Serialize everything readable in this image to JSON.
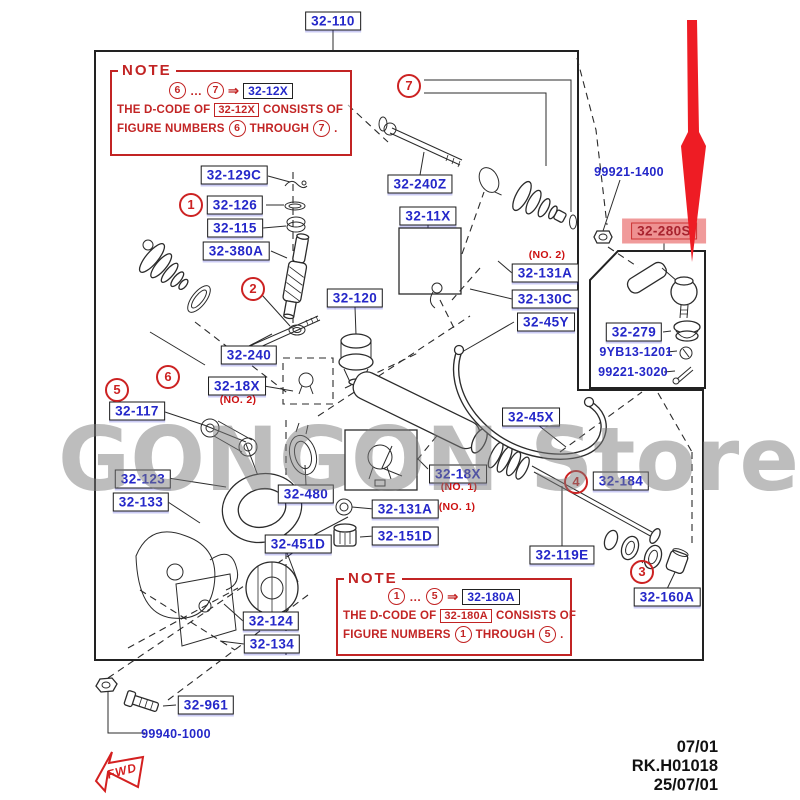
{
  "meta": {
    "store_watermark": "GONGON Store"
  },
  "colors": {
    "label_blue": "#2427c9",
    "note_red": "#c22424",
    "highlight_pink": "#f09a9a",
    "arrow_red": "#ee1c24",
    "line": "#2b2b2b",
    "watermark_gray": "#7d7d7d"
  },
  "header": {
    "assembly_label": "32-110"
  },
  "notes": {
    "top": {
      "heading": "NOTE",
      "from": "6",
      "dots": "…",
      "to": "7",
      "arrow": "⇒",
      "code": "32-12X",
      "line2_a": "THE D-CODE OF",
      "line2_b": "CONSISTS OF",
      "line3_a": "FIGURE NUMBERS",
      "line3_b": "THROUGH",
      "period": "."
    },
    "bottom": {
      "heading": "NOTE",
      "from": "1",
      "dots": "…",
      "to": "5",
      "arrow": "⇒",
      "code": "32-180A",
      "line2_a": "THE D-CODE OF",
      "line2_b": "CONSISTS OF",
      "line3_a": "FIGURE NUMBERS",
      "line3_b": "THROUGH",
      "period": "."
    }
  },
  "part_labels": [
    {
      "t": "32-110",
      "x": 333,
      "y": 21
    },
    {
      "t": "32-129C",
      "x": 234,
      "y": 175
    },
    {
      "t": "32-126",
      "x": 235,
      "y": 205
    },
    {
      "t": "32-115",
      "x": 235,
      "y": 228
    },
    {
      "t": "32-380A",
      "x": 236,
      "y": 251
    },
    {
      "t": "32-240Z",
      "x": 420,
      "y": 184
    },
    {
      "t": "32-11X",
      "x": 428,
      "y": 216
    },
    {
      "t": "32-120",
      "x": 355,
      "y": 298
    },
    {
      "t": "32-131A",
      "x": 545,
      "y": 273
    },
    {
      "t": "32-130C",
      "x": 545,
      "y": 299
    },
    {
      "t": "32-45Y",
      "x": 546,
      "y": 322
    },
    {
      "t": "32-240",
      "x": 249,
      "y": 355
    },
    {
      "t": "32-18X",
      "x": 237,
      "y": 386
    },
    {
      "t": "32-117",
      "x": 137,
      "y": 411
    },
    {
      "t": "32-45X",
      "x": 531,
      "y": 417
    },
    {
      "t": "32-123",
      "x": 143,
      "y": 479
    },
    {
      "t": "32-133",
      "x": 141,
      "y": 502
    },
    {
      "t": "32-480",
      "x": 306,
      "y": 494
    },
    {
      "t": "32-18X",
      "x": 458,
      "y": 474
    },
    {
      "t": "32-131A",
      "x": 405,
      "y": 509
    },
    {
      "t": "32-151D",
      "x": 405,
      "y": 536
    },
    {
      "t": "32-451D",
      "x": 298,
      "y": 544
    },
    {
      "t": "32-119E",
      "x": 562,
      "y": 555
    },
    {
      "t": "32-184",
      "x": 621,
      "y": 481
    },
    {
      "t": "32-160A",
      "x": 667,
      "y": 597
    },
    {
      "t": "32-124",
      "x": 271,
      "y": 621
    },
    {
      "t": "32-134",
      "x": 272,
      "y": 644
    },
    {
      "t": "32-961",
      "x": 206,
      "y": 705
    },
    {
      "t": "32-279",
      "x": 634,
      "y": 332
    }
  ],
  "plain_labels": [
    {
      "t": "99921-1400",
      "x": 629,
      "y": 172
    },
    {
      "t": "9YB13-1201",
      "x": 636,
      "y": 352
    },
    {
      "t": "99221-3020",
      "x": 633,
      "y": 372
    },
    {
      "t": "99940-1000",
      "x": 176,
      "y": 734
    }
  ],
  "highlight_label": {
    "t": "32-280S",
    "x": 664,
    "y": 231
  },
  "red_notes": [
    {
      "t": "(NO. 2)",
      "x": 547,
      "y": 255
    },
    {
      "t": "(NO. 2)",
      "x": 238,
      "y": 400
    },
    {
      "t": "(NO. 1)",
      "x": 459,
      "y": 487
    },
    {
      "t": "(NO. 1)",
      "x": 457,
      "y": 507
    }
  ],
  "callouts": [
    {
      "n": "1",
      "x": 191,
      "y": 205
    },
    {
      "n": "2",
      "x": 253,
      "y": 289
    },
    {
      "n": "3",
      "x": 642,
      "y": 572
    },
    {
      "n": "4",
      "x": 576,
      "y": 482
    },
    {
      "n": "5",
      "x": 117,
      "y": 390
    },
    {
      "n": "6",
      "x": 168,
      "y": 377
    },
    {
      "n": "7",
      "x": 409,
      "y": 86
    }
  ],
  "fwd": {
    "label": "FWD"
  },
  "footer": {
    "rev": "07/01",
    "code": "RK.H01018",
    "date": "25/07/01"
  }
}
